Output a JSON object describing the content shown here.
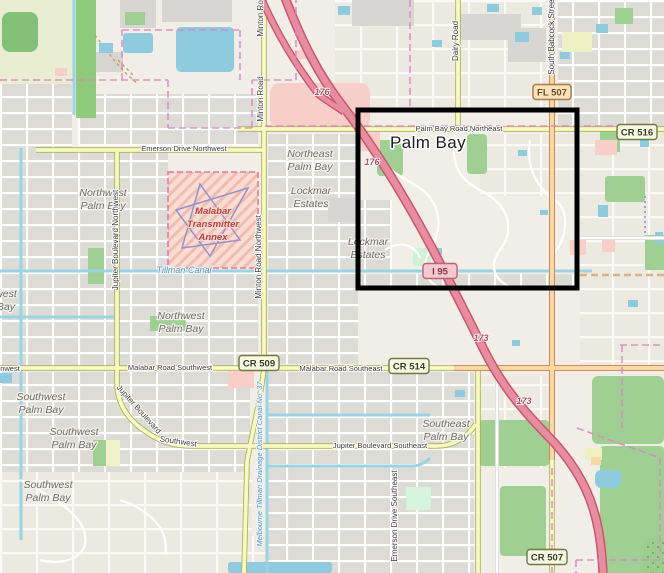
{
  "map": {
    "type": "openstreetmap-style street map with black highlight rectangle",
    "city_label": "Palm Bay",
    "colors": {
      "land": "#f1eee7",
      "water": "#8ecbdf",
      "motorway": "#e88da0",
      "primary_road": "#fcd6a4",
      "secondary_road": "#f7fabf",
      "residential_block": "#dddbd5",
      "green_area": "#a0cf93",
      "retail_pink": "#f7cfc8",
      "military_area": "#f9ddd3",
      "admin_boundary": "#d98ac4",
      "highlight_box": "#000000"
    },
    "neighborhoods": [
      {
        "line1": "Northeast",
        "line2": "Palm Bay"
      },
      {
        "line1": "Lockmar",
        "line2": "Estates"
      },
      {
        "line1": "Lockmar",
        "line2": "Estates"
      },
      {
        "line1": "Northwest",
        "line2": "Palm Bay"
      },
      {
        "line1": "Northwest",
        "line2": "Palm Bay"
      },
      {
        "line1": "Southwest",
        "line2": "Palm Bay"
      },
      {
        "line1": "Southwest",
        "line2": "Palm Bay"
      },
      {
        "line1": "Southwest",
        "line2": "Palm Bay"
      },
      {
        "line1": "Southeast",
        "line2": "Palm Bay"
      },
      {
        "line1": "west",
        "line2": "Bay"
      }
    ],
    "road_labels": {
      "palm_bay_road_ne": "Palm Bay Road Northeast",
      "emerson_nw": "Emerson Drive Northwest",
      "malabar_sw": "Malabar Road Southwest",
      "malabar_se": "Malabar Road Southeast",
      "jupiter_se": "Jupiter Boulevard Southeast",
      "minton": "Minton Road",
      "minton_partial": "Minton Road",
      "minton_nw": "Minton Road Northwest",
      "jupiter_nw": "Jupiter Boulevard Northwest",
      "dairy": "Dairy Road",
      "babcock": "South Babcock Street",
      "emerson_se": "Emerson Drive Southeast",
      "jupiter_word": "Jupiter Boulevard",
      "southwest_word": "Southwest",
      "edge_partial": "nwest"
    },
    "exit_refs": [
      "176",
      "176",
      "173",
      "173"
    ],
    "water_labels": {
      "tillman": "Tillman Canal",
      "drainage": "Melbourne Tillman Drainage District Canal No. 37"
    },
    "military_area": {
      "line1": "Malabar",
      "line2": "Transmitter",
      "line3": "Annex"
    },
    "shields": {
      "fl507": "FL 507",
      "cr516": "CR 516",
      "cr509": "CR 509",
      "cr514": "CR 514",
      "cr507": "CR 507",
      "i95": "I 95"
    }
  }
}
